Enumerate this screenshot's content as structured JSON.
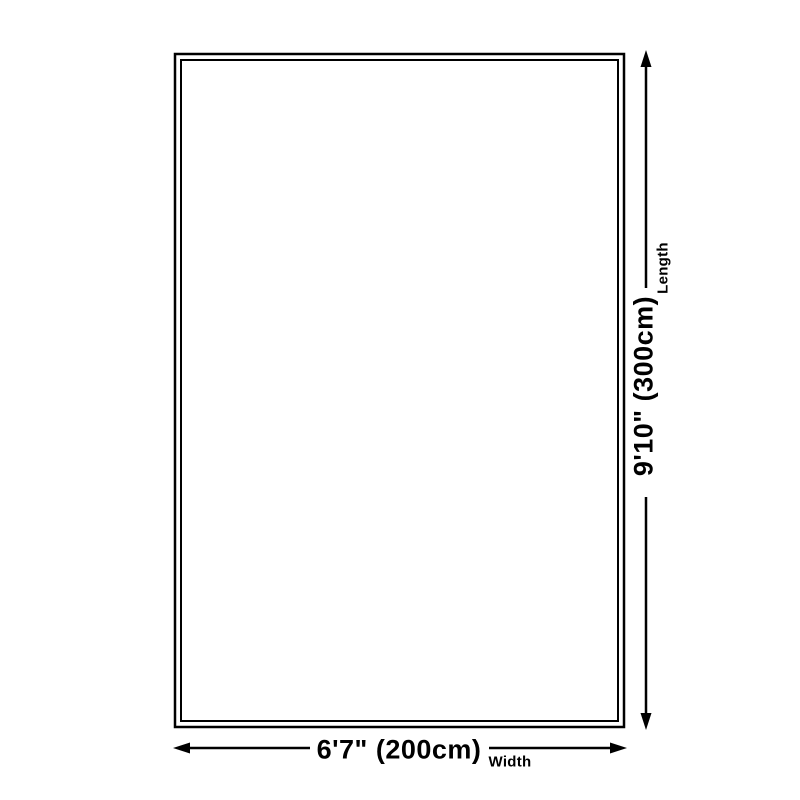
{
  "diagram": {
    "shape": "rectangle",
    "dimensions": {
      "width": {
        "value": "6'7\" (200cm)",
        "label": "Width"
      },
      "length": {
        "value": "9'10\" (300cm)",
        "label": "Length"
      }
    },
    "colors": {
      "line": "#000000",
      "background": "#ffffff"
    }
  }
}
